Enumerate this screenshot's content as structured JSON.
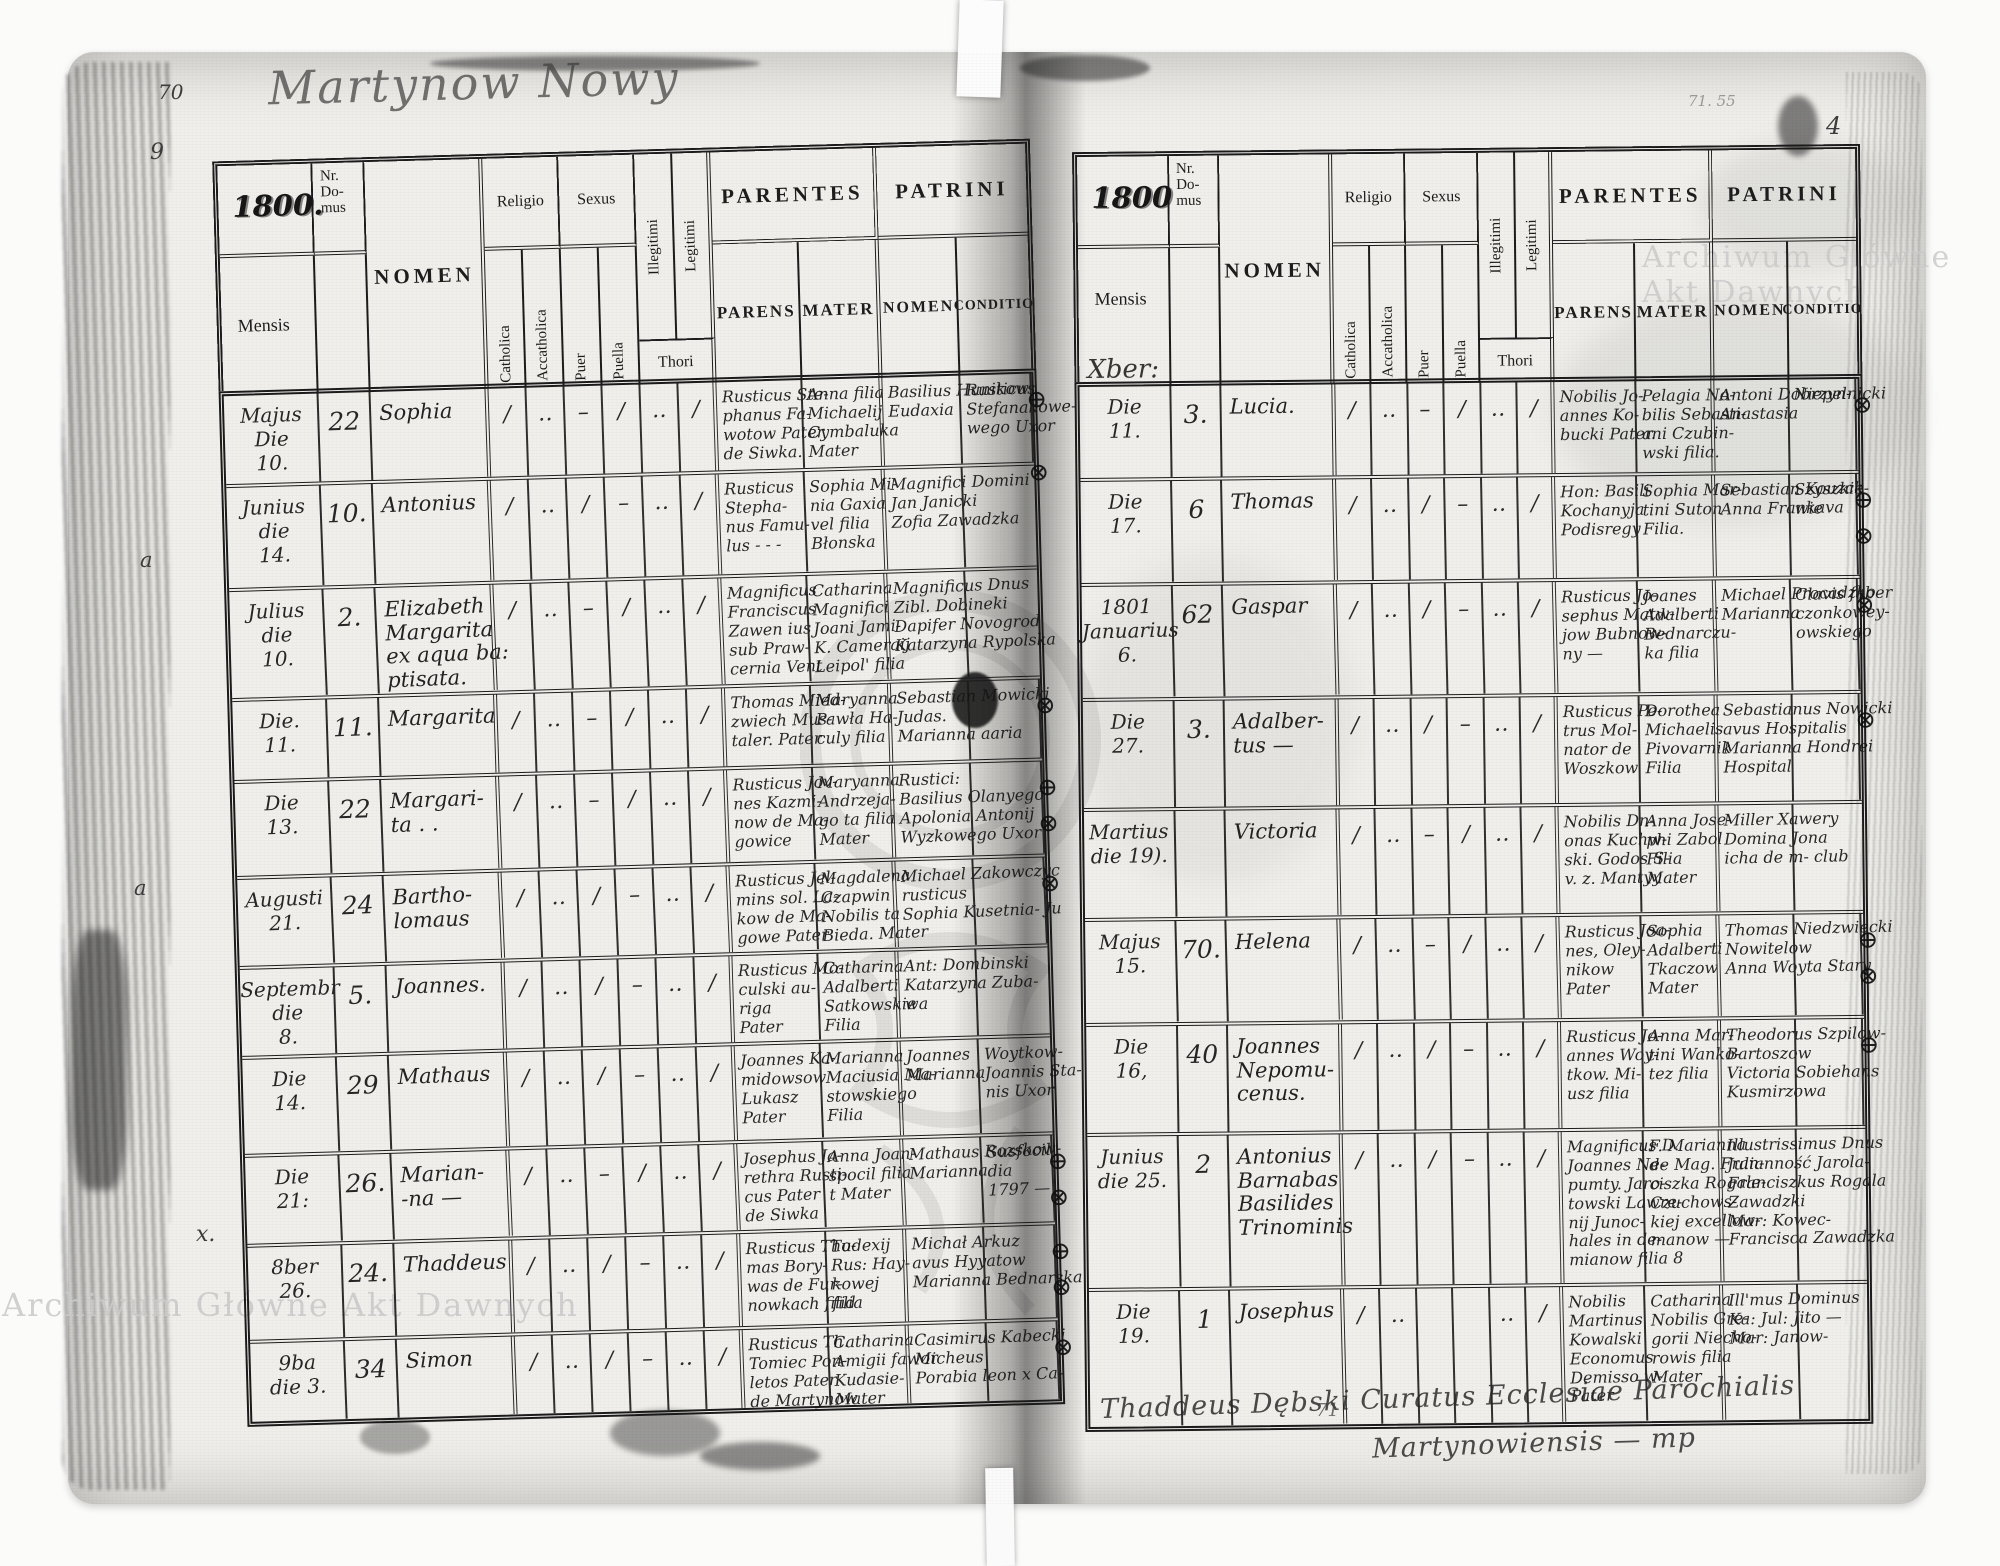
{
  "document": {
    "kind": "scanned parish baptism register, two-page spread",
    "title_handwritten": "Martynow Nowy",
    "watermark_text": "Archiwum Główne Akt Dawnych",
    "colors": {
      "page": "#f0efeb",
      "ink": "#161616",
      "print": "#1d1d1d",
      "watermark": "#cccccc"
    }
  },
  "header_labels": {
    "nr_domus": "Nr.\nDo-\nmus",
    "mensis": "Mensis",
    "nomen": "NOMEN",
    "religio": "Religio",
    "sexus": "Sexus",
    "catholica": "Catholica",
    "accatholica": "Accatholica",
    "puer": "Puer",
    "puella": "Puella",
    "illegitimi": "Illegitimi",
    "legitimi": "Legitimi",
    "thori": "Thori",
    "parentes": "PARENTES",
    "patrini": "PATRINI",
    "parens": "PARENS",
    "mater": "MATER",
    "p_nomen": "NOMEN",
    "conditio": "CONDITIO"
  },
  "left_page": {
    "page_no": "70",
    "margin_note_9": "9",
    "margin_a1": "a",
    "margin_a2": "a",
    "margin_x": "x.",
    "year": "1800.",
    "rows": [
      {
        "m": "Majus\nDie\n10.",
        "nr": "22",
        "name": "Sophia",
        "marks": [
          "∕",
          "‥",
          "–",
          "∕",
          "‥",
          "∕"
        ],
        "parens": "Rusticus Ste-\nphanus Fa-\nwotow Pater\nde Siwka.",
        "mater": "Anna filia\nMichaelij\nCymbaluka\nMater",
        "pn": "Basilius Hunikow\nEudaxia",
        "cond": "Rusticus\nStefanakowe-\nwego Uxor",
        "sym": "⊕\n\n⊗"
      },
      {
        "m": "Junius\ndie\n14.",
        "nr": "10.",
        "name": "Antonius",
        "marks": [
          "∕",
          "‥",
          "∕",
          "–",
          "‥",
          "∕"
        ],
        "parens": "Rusticus\nStepha-\nnus Famu-\nlus - - -",
        "mater": "Sophia Mi-\nnia Gaxia\nvel filia\nBłonska",
        "pn": "Magnifici Domini\nJan Janicki\nZofia Zawadzka",
        "cond": "",
        "sym": ""
      },
      {
        "m": "Julius\ndie\n10.",
        "nr": "2.",
        "name": "Elizabeth\nMargarita\nex aqua ba:\nptisata.",
        "marks": [
          "∕",
          "‥",
          "–",
          "∕",
          "‥",
          "∕"
        ],
        "parens": "Magnificus\nFranciscus\nZawen ius\nsub Praw-\ncernia Vent",
        "mater": "Catharina\nMagnifici\nJoani Jami-\nK. Cameraij\nLeipol' filia",
        "pn": "Magnificus Dnus\nZibl. Dobineki\nDapifer Novogrod\nKatarzyna Rypolska",
        "cond": "",
        "sym": ""
      },
      {
        "m": "Die.\n11.",
        "nr": "11.",
        "name": "Margarita",
        "marks": [
          "∕",
          "‥",
          "–",
          "∕",
          "‥",
          "∕"
        ],
        "parens": "Thomas Mied-\nzwiech Mus-\ntaler. Pater",
        "mater": "Maryanna\nPawła Ha-\nculy filia",
        "pn": "Sebastian Mowicki\nJudas.\nMarianna aaria",
        "cond": "",
        "sym": "⊗"
      },
      {
        "m": "Die\n13.",
        "nr": "22",
        "name": "Margari-\nta . .",
        "marks": [
          "∕",
          "‥",
          "–",
          "∕",
          "‥",
          "∕"
        ],
        "parens": "Rusticus Jov-\nnes Kazmi-\nnow de Ma-\ngowice",
        "mater": "Maryanna\nAndrzeja-\ngo ta filia\nMater",
        "pn": "Rustici:\nBasilius Olanyego\nApolonia Antonij\nWyzkowego Uxor",
        "cond": "",
        "sym": "⊕\n⊗"
      },
      {
        "m": "Augusti\n21.",
        "nr": "24",
        "name": "Bartho-\nlomaus",
        "marks": [
          "∕",
          "‥",
          "∕",
          "–",
          "‥",
          "∕"
        ],
        "parens": "Rusticus Jel-\nmins sol. La-\nkow de Ma-\ngowe Pater",
        "mater": "Magdalena\nCzapwin\nNobilis ta\nBieda. Mater",
        "pn": "Michael Zakowczyc\nrusticus\nSophia Kusetnia- Ju",
        "cond": "",
        "sym": "⊗"
      },
      {
        "m": "Septembr\ndie\n8.",
        "nr": "5.",
        "name": "Joannes.",
        "marks": [
          "∕",
          "‥",
          "∕",
          "–",
          "‥",
          "∕"
        ],
        "parens": "Rusticus Mo-\nculski au-\nriga\nPater",
        "mater": "Catharina\nAdalberti\nSatkowskie\nFilia",
        "pn": "Ant: Dombinski\nKatarzyna Zuba-\nwa",
        "cond": "",
        "sym": ""
      },
      {
        "m": "Die\n14.",
        "nr": "29",
        "name": "Mathaus",
        "marks": [
          "∕",
          "‥",
          "∕",
          "–",
          "‥",
          "∕"
        ],
        "parens": "Joannes Ka-\nmidowsow\nLukasz\nPater",
        "mater": "Marianna\nMaciusia Ma-\nstowskiego\nFilia",
        "pn": "Joannes\nMarianna",
        "cond": "Woytkow-\nJoannis Sta-\nnis Uxor",
        "sym": ""
      },
      {
        "m": "Die\n21:",
        "nr": "26.",
        "name": "Marian-\n-na —",
        "marks": [
          "∕",
          "‥",
          "–",
          "∕",
          "‥",
          "∕"
        ],
        "parens": "Josephus Ja-\nrethra Rusti-\ncus Pater\nde Siwka",
        "mater": "Anna Joan-\nspocil filia\nt Mater",
        "pn": "Mathaus Rozskow-\nMarianna",
        "cond": "Susfocil\ndia\n1797 —",
        "sym": "⊕\n⊗"
      },
      {
        "m": "8ber\n26.",
        "nr": "24.",
        "name": "Thaddeus",
        "marks": [
          "∕",
          "‥",
          "∕",
          "–",
          "‥",
          "∕"
        ],
        "parens": "Rusticus Tho-\nmas Bory-\nwas de Fur-\nnowkach filid",
        "mater": "Tudexij\nRus: Hay-\nkowej\nfilia",
        "pn": "Michał Arkuz\navus Hyyatow\nMarianna Bednarska",
        "cond": "",
        "sym": "⊕\n⊗"
      },
      {
        "m": "9ba\ndie 3.",
        "nr": "34",
        "name": "Simon",
        "marks": [
          "∕",
          "‥",
          "∕",
          "–",
          "‥",
          "∕"
        ],
        "parens": "Rusticus Th.\nTomiec Pon-\nletos Pater\nde Martynow",
        "mater": "Catharina\nAmigii fawor\nKudasie-\nMater",
        "pn": "Casimirus Kabecki\nMicheus\nPorabia leon x Ca-",
        "cond": "",
        "sym": "⊗"
      }
    ]
  },
  "right_page": {
    "page_no": "4",
    "corner_note": "71. 55",
    "year": "1800",
    "mensis_note": "Xber:",
    "footer_line1": "Thaddeus Dębski Curatus Ecclesiae Parochialis",
    "footer_line2": "Martynowiensis — mp",
    "footer_page": "71",
    "rows": [
      {
        "m": "Die\n11.",
        "nr": "3.",
        "name": "Lucia.",
        "marks": [
          "∕",
          "‥",
          "–",
          "∕",
          "‥",
          "∕"
        ],
        "parens": "Nobilis Jo-\nannes Ko-\nbucki Pater.",
        "mater": "Pelagia No-\nbilis Sebasti-\nani Czubin-\nwski filia.",
        "pn": "Antoni Dobrzyn-\nAnastasia",
        "cond": "Niepelnicki",
        "sym": "⊗"
      },
      {
        "m": "Die\n17.",
        "nr": "6",
        "name": "Thomas",
        "marks": [
          "∕",
          "‥",
          "∕",
          "–",
          "‥",
          "∕"
        ],
        "parens": "Hon: Basili\nKochanyja\nPodisregy",
        "mater": "Sophia Mar-\ntini Suton\nFilia.",
        "pn": "Sebastian Kouzck\nAnna Frankava",
        "cond": "Szyszkie-\nwie",
        "sym": "⊕\n⊗"
      },
      {
        "m": "1801\nJanuarius\n6.",
        "nr": "62",
        "name": "Gaspar",
        "marks": [
          "∕",
          "‥",
          "∕",
          "–",
          "‥",
          "∕"
        ],
        "parens": "Rusticus Jo-\nsephus Matw-\njow Bubnow-\nny —",
        "mater": "Joanes\nAdalberti\nBednarczu-\nka filia",
        "pn": "Michael Procadzko\nMarianna",
        "cond": "Clavis faber\nczonkowey-\nowskiego",
        "sym": "⊗"
      },
      {
        "m": "Die\n27.",
        "nr": "3.",
        "name": "Adalber-\ntus —",
        "marks": [
          "∕",
          "‥",
          "∕",
          "–",
          "‥",
          "∕"
        ],
        "parens": "Rusticus Pe-\ntrus Mol-\nnator de\nWoszkow",
        "mater": "Dorothea\nMichaelis\nPivovarnik\nFilia",
        "pn": "Sebastianus Nowicki\navus Hospitalis\nMarianna Hondrei\nHospital",
        "cond": "",
        "sym": "⊗"
      },
      {
        "m": "Martius\ndie 19).",
        "nr": "",
        "name": "Victoria",
        "marks": [
          "∕",
          "‥",
          "–",
          "∕",
          "‥",
          "∕"
        ],
        "parens": "Nobilis Dn-\nonas Kuchw-\nski. Godos S-\nv. z. Mantyy",
        "mater": "Anna Jose-\nphi Zabol\nFilia\nMater",
        "pn": "Miller Xawery\nDomina Jona\nicha de m- club",
        "cond": "",
        "sym": ""
      },
      {
        "m": "Majus\n15.",
        "nr": "70.",
        "name": "Helena",
        "marks": [
          "∕",
          "‥",
          "–",
          "∕",
          "‥",
          "∕"
        ],
        "parens": "Rusticus Joa-\nnes, Oley-\nnikow\nPater",
        "mater": "Sophia\nAdalberti\nTkaczow\nMater",
        "pn": "Thomas Niedzwiecki\nNowitelow\nAnna Woyta Stary",
        "cond": "",
        "sym": "⊕\n⊗"
      },
      {
        "m": "Die\n16,",
        "nr": "40",
        "name": "Joannes\nNepomu-\ncenus.",
        "marks": [
          "∕",
          "‥",
          "∕",
          "–",
          "‥",
          "∕"
        ],
        "parens": "Rusticus Jo-\nannes Woy-\ntkow. Mi-\nusz filia",
        "mater": "Anna Mar-\ntini Wanko-\ntez filia",
        "pn": "Theodorus Szpilow-\nBartoszow\nVictoria Sobiehans\nKusmirzowa",
        "cond": "",
        "sym": "⊕"
      },
      {
        "m": "Junius\ndie 25.",
        "nr": "2",
        "name": "Antonius\nBarnabas\nBasilides\nTrinominis",
        "marks": [
          "∕",
          "‥",
          "∕",
          "–",
          "‥",
          "∕"
        ],
        "parens": "Magnificus D.\nJoannes Ne-\npumty. Jaro-\ntowski Lawre-\nnij Junoc-\nhales in de-\nmianow filia 8",
        "mater": "F. Marianna\nde Mag. Fran-\nciszka Rogale-\nCzuchows-\nkiej excellow-\nmanow —",
        "pn": "Illustrissimus Dnus\nJulianność Jarola-\nFranciszkus Rogala\nZawadzki\nMar: Kowec-\nFrancisca Zawadzka",
        "cond": "",
        "sym": ""
      },
      {
        "m": "Die\n19.",
        "nr": "1",
        "name": "Josephus",
        "marks": [
          "∕",
          "‥",
          "",
          "",
          "‥",
          "∕"
        ],
        "parens": "Nobilis\nMartinus\nKowalski\nEconomus\nDemisso w-\nPater",
        "mater": "Catharina\nNobilis Gre-\ngorii Niecho-\nrowis filia\nMater",
        "pn": "Ill'mus Dominus\nKa: Jul: Jito —\nMar: Janow-",
        "cond": "",
        "sym": ""
      }
    ]
  }
}
